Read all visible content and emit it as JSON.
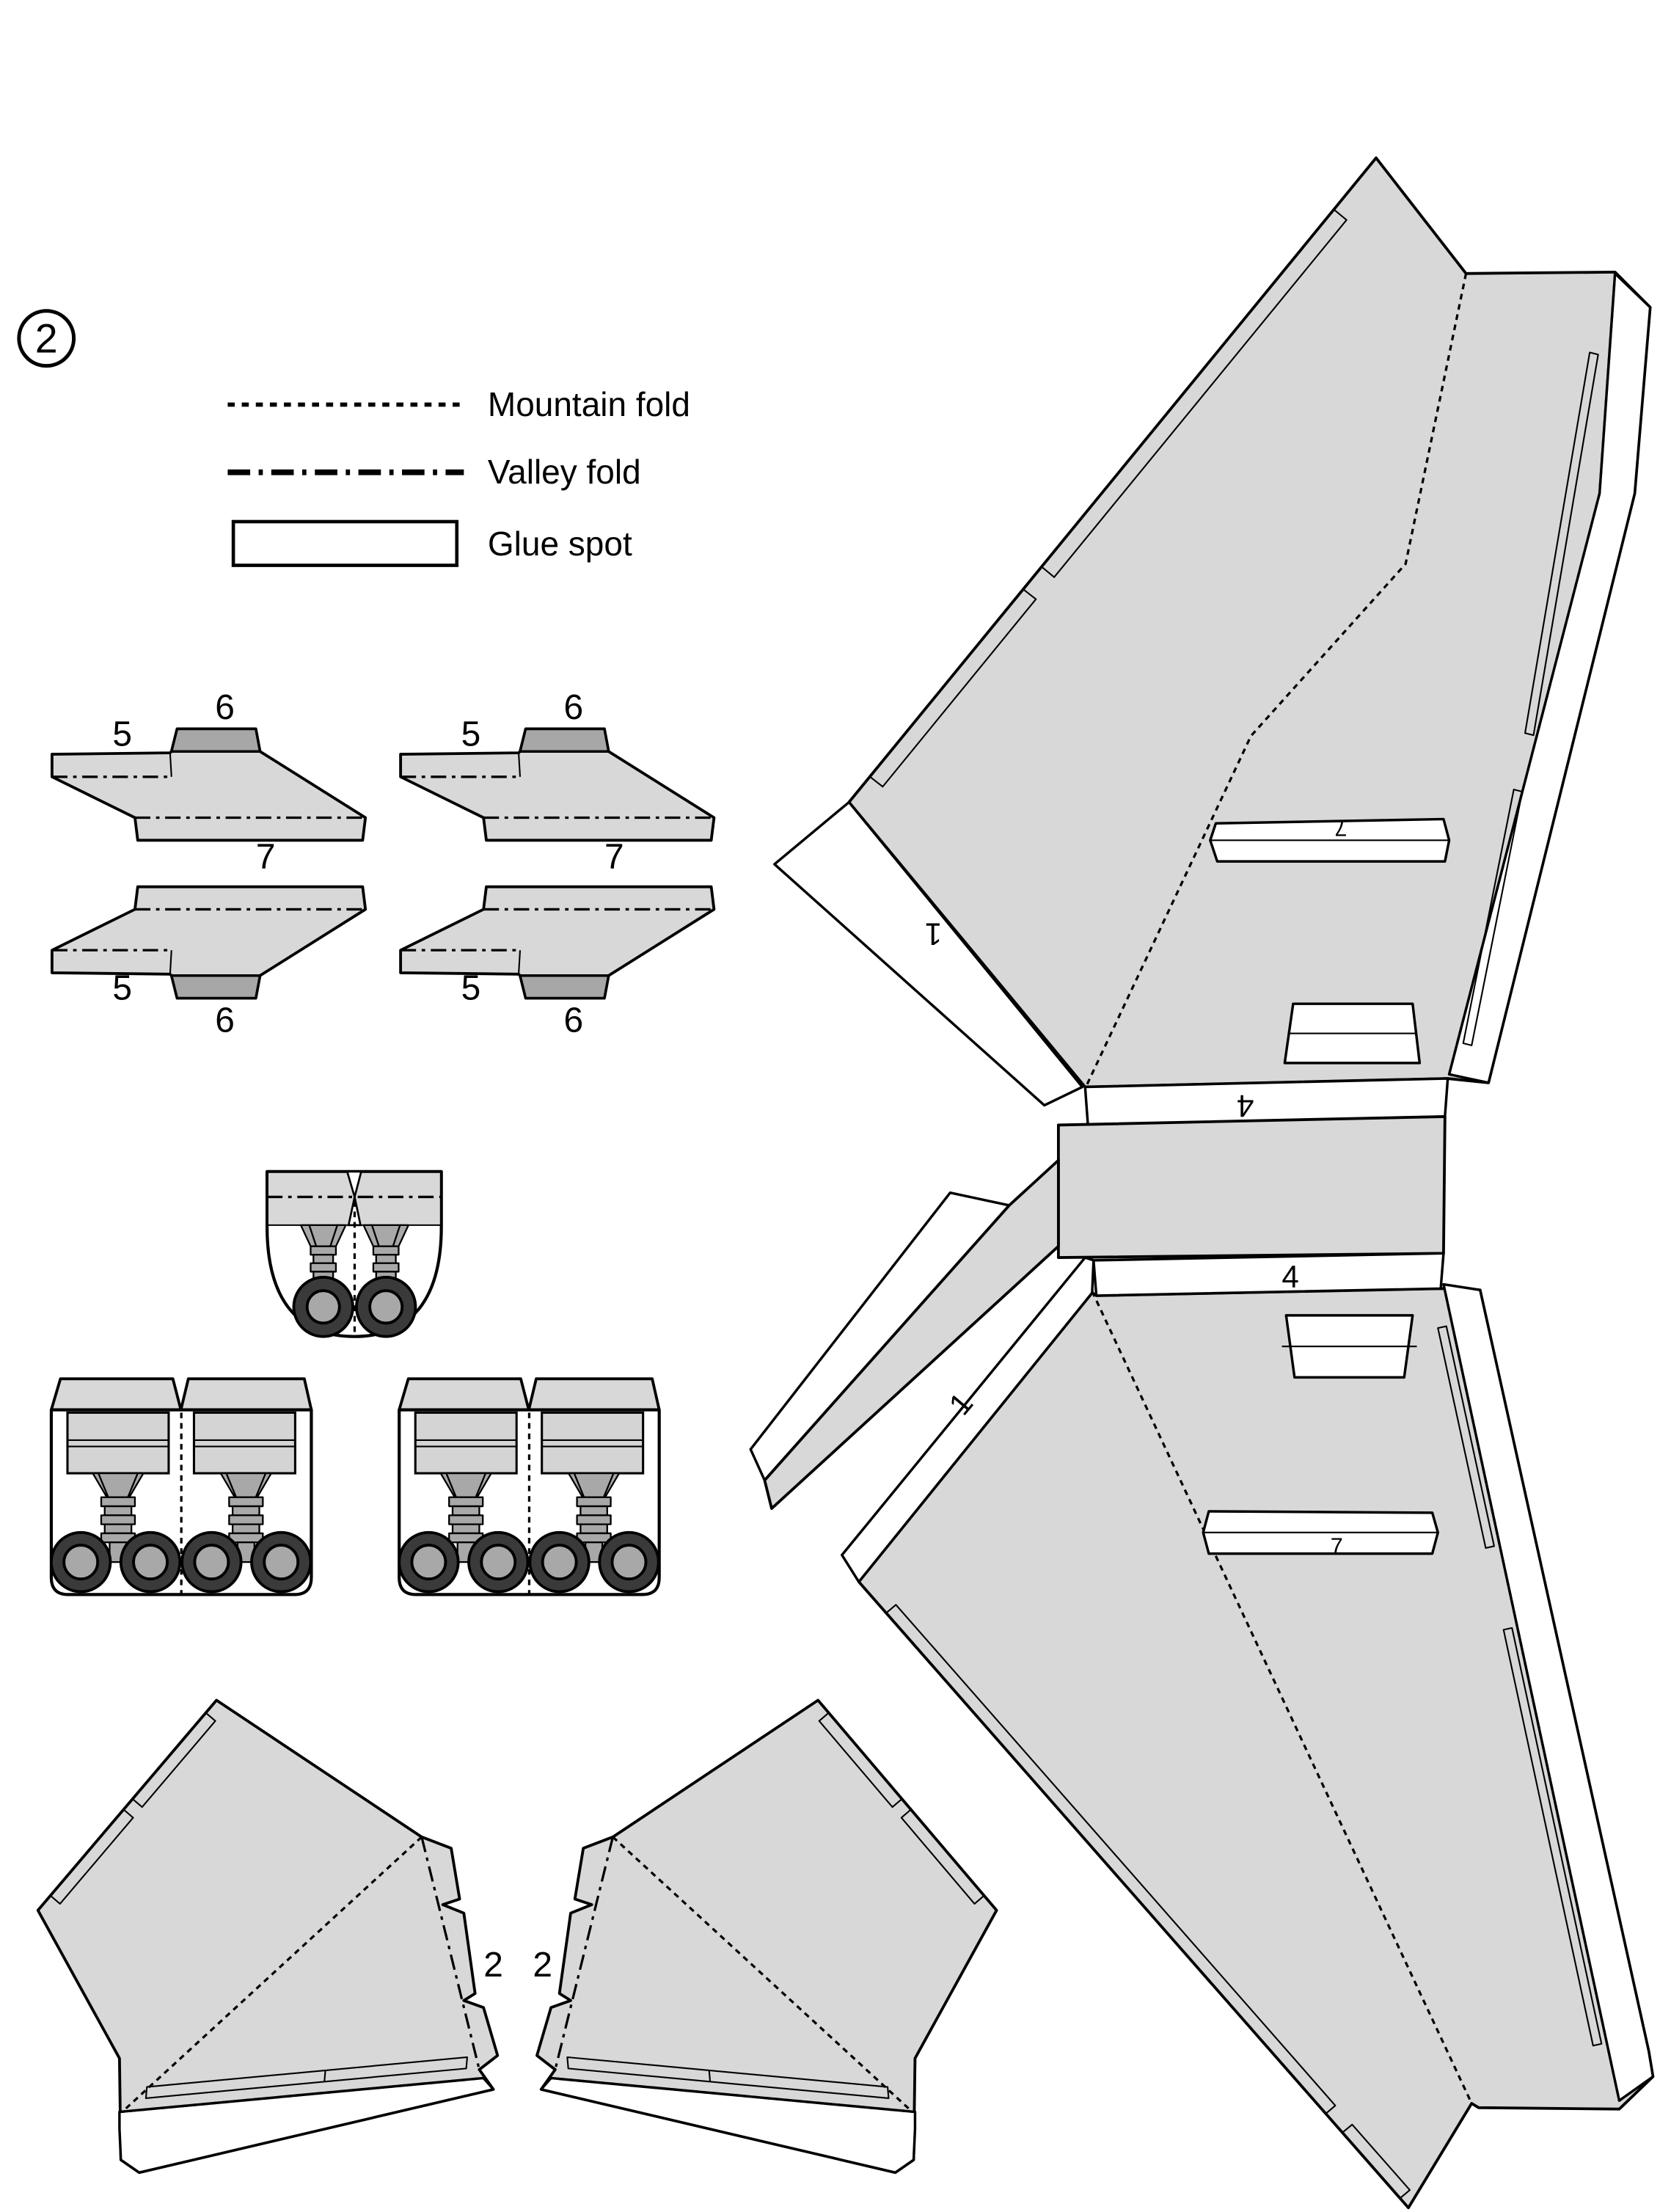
{
  "page": {
    "sheet_number": "2"
  },
  "legend": {
    "mountain": "Mountain fold",
    "valley": "Valley fold",
    "glue": "Glue spot"
  },
  "labels": {
    "one": "1",
    "two": "2",
    "four": "4",
    "five": "5",
    "six": "6",
    "seven": "7"
  },
  "colors": {
    "glue_green": "#1f9e1f",
    "piece_gray": "#d8d8d8",
    "dark_tab": "#a7a7a7",
    "strut_gray": "#a8a8a8",
    "tire_dark": "#3a3a3a",
    "line": "#000000"
  }
}
